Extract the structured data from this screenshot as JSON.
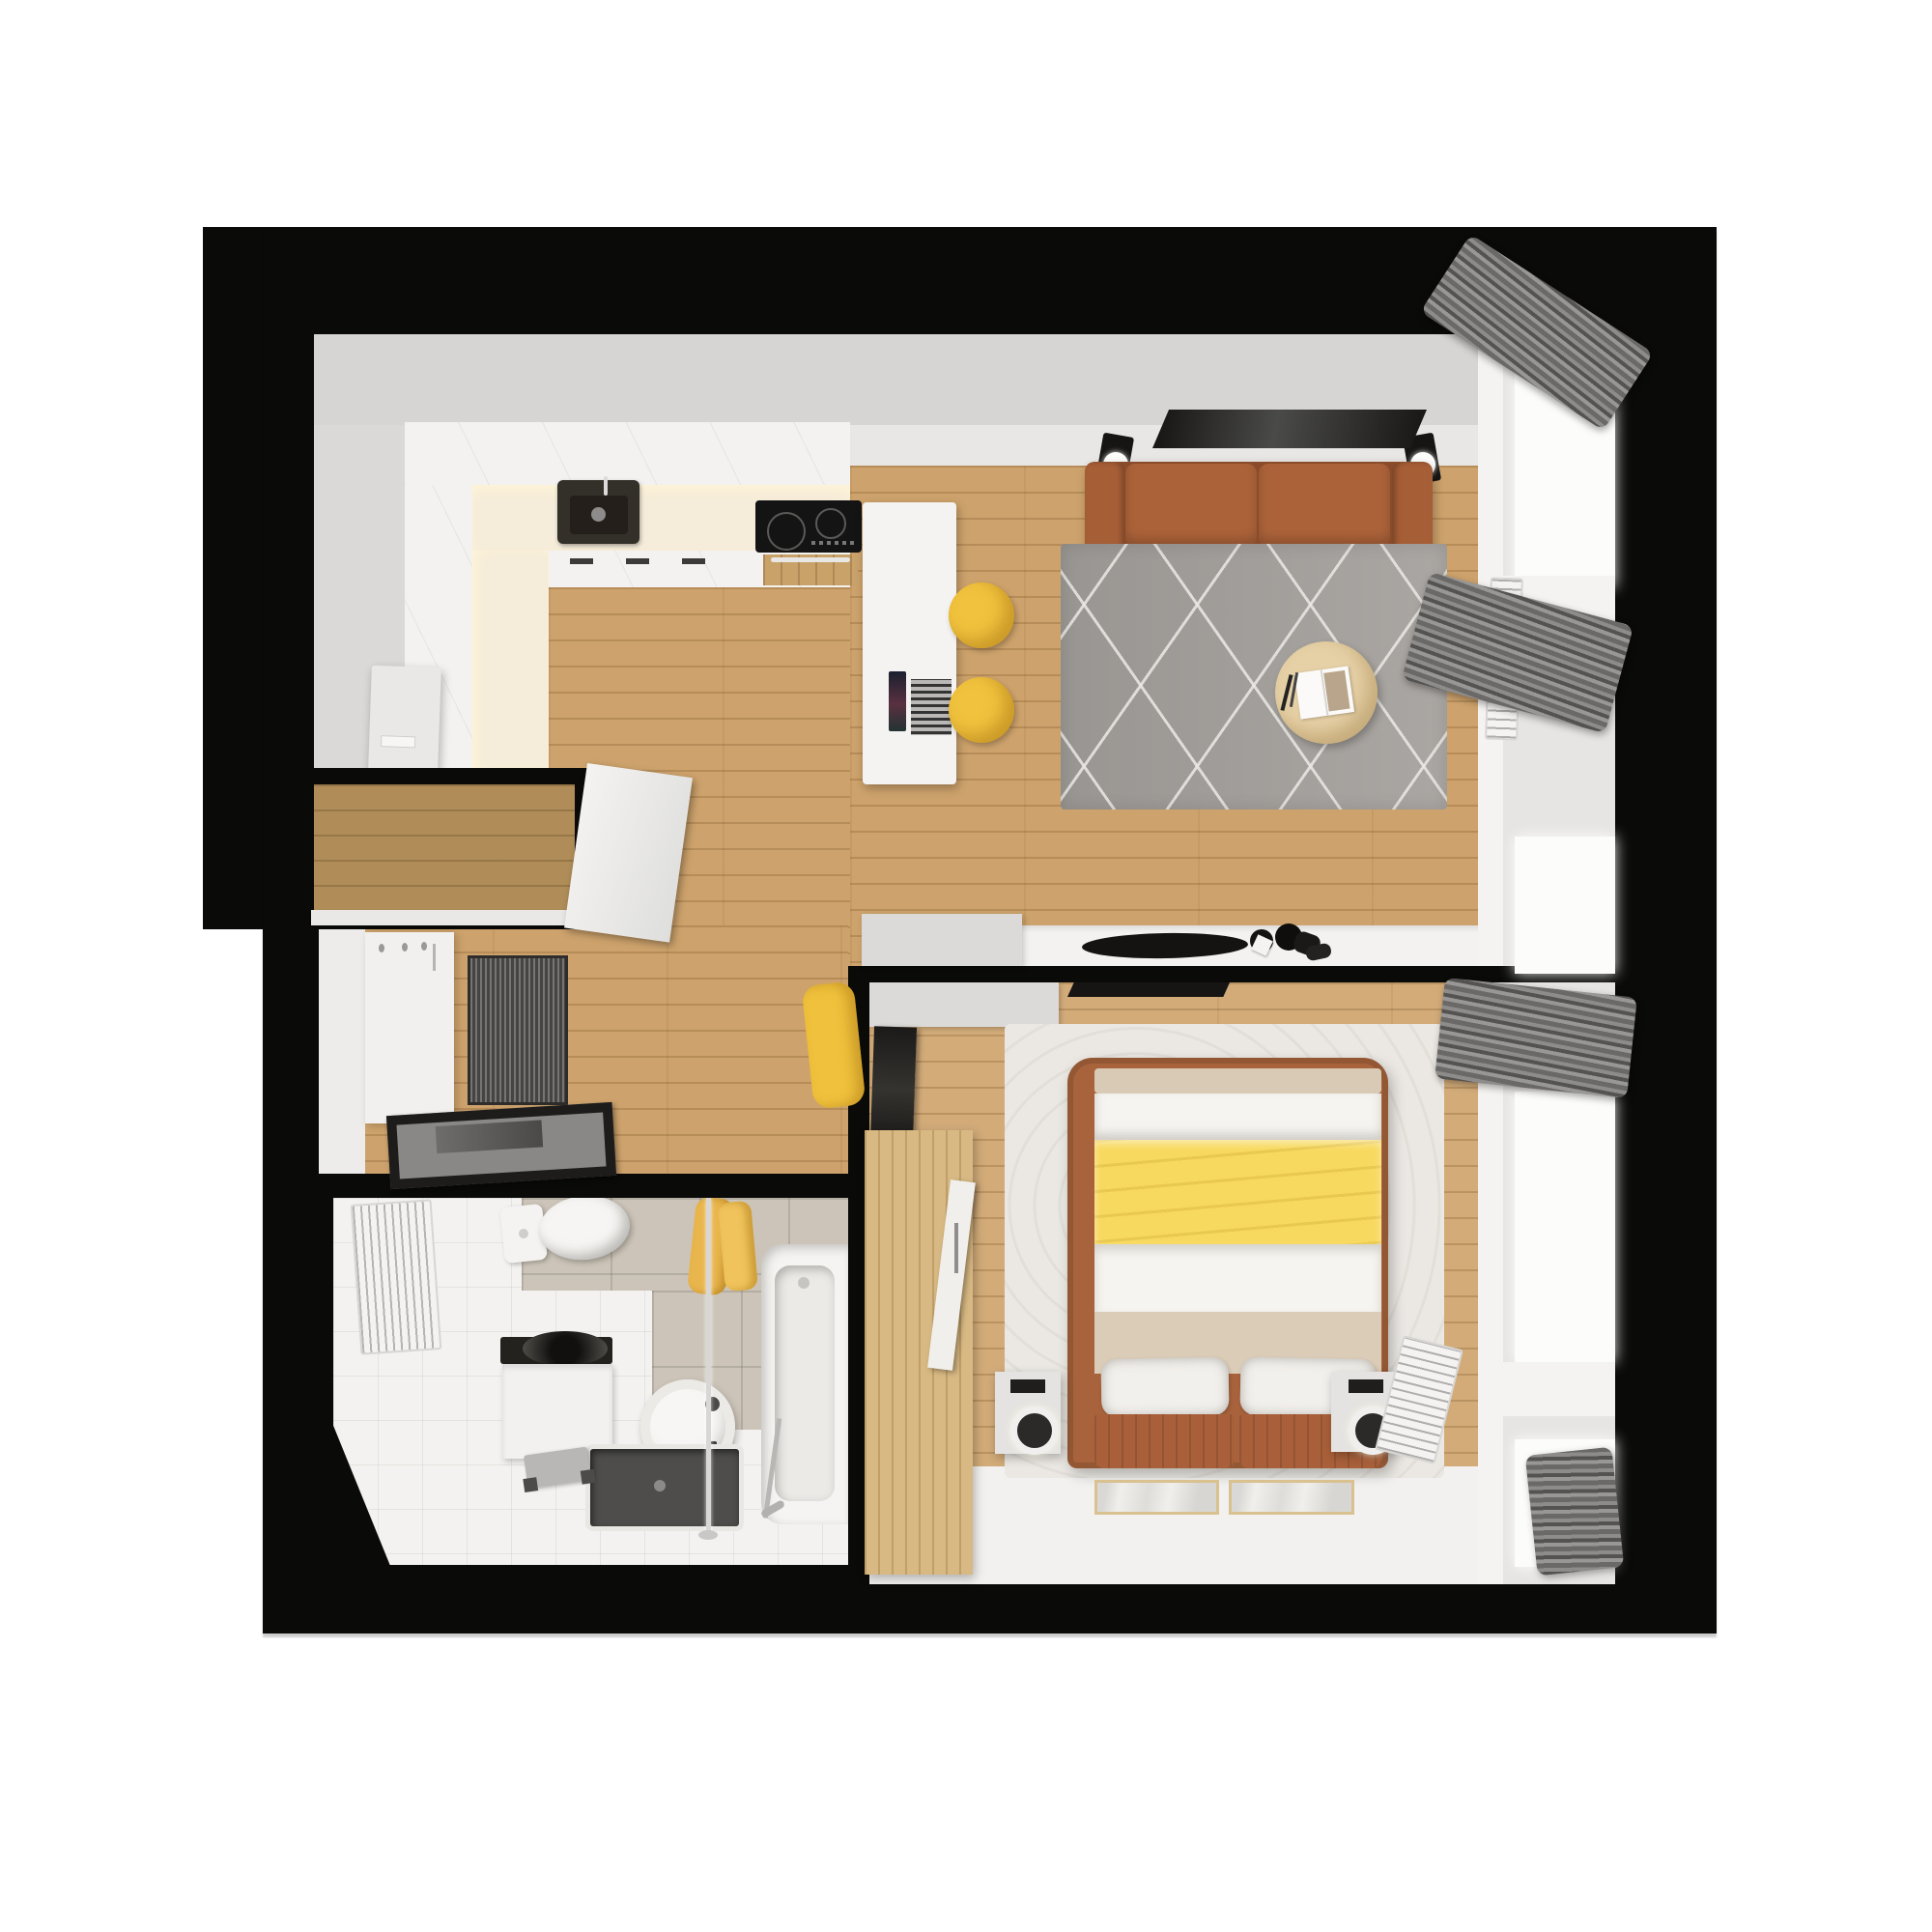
{
  "scene": {
    "type": "3d-rendered-floor-plan-top-view",
    "subject": "one-bedroom apartment",
    "orientation": "overhead dollhouse view, thick black exterior walls, white page background"
  },
  "colors": {
    "wall_black": "#0a0a09",
    "floor_wood": "#cda26c",
    "wall_gray": "#d7d5d3",
    "living_wall": "#e9e7e5",
    "cabinet_white": "#f3f2f0",
    "counter_cream": "#f5ecda",
    "sink_dark": "#332f29",
    "cooktop_black": "#141414",
    "oven_wood": "#c9a26a",
    "island_white": "#f4f3f1",
    "stool_yellow": "#f0c23d",
    "chair_yellow": "#efc13c",
    "sofa_terracotta": "#a86038",
    "sofa_dark": "#8a4b2b",
    "rug_gray": "#a5a19d",
    "table_wood": "#e6d0a6",
    "curtain_gray": "#777573",
    "window_white": "#f4f3f1",
    "pane_white": "#fcfcfb",
    "sill_gray": "#e7e5e3",
    "door_brown": "#b08d58",
    "mat_gray": "#5d5b59",
    "mirror_black": "#1d1c1b",
    "tile_beige": "#ccc4b8",
    "bath_floor": "#f3f2f0",
    "tray_dark": "#4e4d4b",
    "towel_yellow": "#e9b64e",
    "bed_frame": "#a8633c",
    "blanket_yellow": "#f8d95f",
    "sheet_white": "#f6f4f0",
    "mattress_beige": "#dbccb7",
    "pillow_white": "#f2f0ec",
    "bedroom_rug": "#ebe8e3",
    "wardrobe_wood": "#d8b983",
    "console_gray": "#dbdad8",
    "tv_black": "#161514",
    "nightstand_gray": "#e5e3e1",
    "marble_white": "#f1efeb",
    "marble_border": "#d9c190",
    "floor_white": "#f2f1ef"
  },
  "rooms": {
    "kitchen": {
      "label": "kitchen",
      "items": [
        "upper-cabinets",
        "cream-countertop",
        "undermount-dark-sink",
        "induction-cooktop",
        "oven",
        "base-cabinets",
        "refrigerator-appliance",
        "kitchen-island",
        "open-laptop",
        "yellow-bar-stool",
        "yellow-bar-stool"
      ]
    },
    "living_room": {
      "label": "living room",
      "items": [
        "terracotta-two-seat-sofa",
        "wall-tv-panel",
        "speaker-lamp-left",
        "speaker-lamp-right",
        "gray-diamond-rug",
        "round-wood-coffee-table",
        "open-magazine",
        "sideboard",
        "decor-bowl",
        "black-vases",
        "gray-cabinet",
        "yellow-accent-chair",
        "window-wall",
        "bunched-gray-curtain-top",
        "bunched-gray-curtain-middle",
        "radiator"
      ]
    },
    "hallway": {
      "label": "entry hallway",
      "items": [
        "entry-vestibule",
        "wood-entry-door",
        "open-white-door-leaf",
        "coat-rack-panel",
        "striped-doormat",
        "leaning-floor-mirror"
      ]
    },
    "bathroom": {
      "label": "bathroom",
      "items": [
        "toilet",
        "towel-radiator",
        "yellow-towels",
        "washing-machine-with-round-basin",
        "round-vessel-sink",
        "shower-tray",
        "step-stool",
        "bathtub",
        "shower-glass-rail"
      ]
    },
    "bedroom": {
      "label": "bedroom",
      "items": [
        "double-bed",
        "yellow-blanket-runner",
        "white-pillows",
        "brown-headboard-cushions",
        "nightstand-left",
        "nightstand-right",
        "table-lamps",
        "oak-wardrobe",
        "leaning-tv",
        "wall-tv",
        "tv-console",
        "textured-cream-rug",
        "marble-floor-mats",
        "window-wall",
        "bunched-gray-curtain",
        "radiator",
        "corner-curtain"
      ]
    }
  }
}
